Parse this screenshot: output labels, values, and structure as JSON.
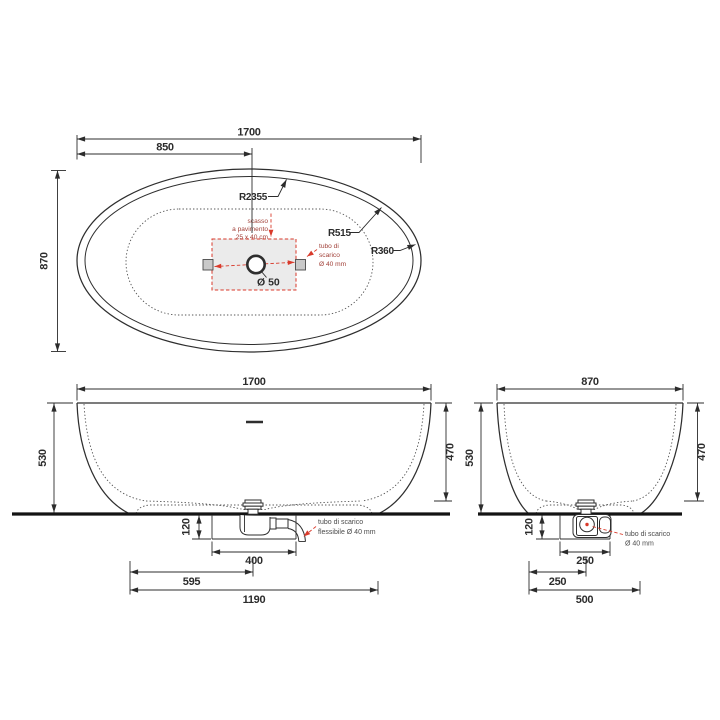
{
  "page": {
    "background": "#ffffff"
  },
  "colors": {
    "line": "#2c2c2c",
    "red_leader": "#d93a2b",
    "annotation_gray": "#4a4a4a",
    "annotation_red": "#a14038",
    "recess_fill": "#ebebeb",
    "foot_fill": "#c9c9c9"
  },
  "top_view": {
    "dim_width": "1700",
    "dim_half_width": "850",
    "dim_depth": "870",
    "radius_side": "R2355",
    "radius_inner": "R515",
    "radius_end": "R360",
    "recess_note_line1": "scasso",
    "recess_note_line2": "a pavimento",
    "recess_note_line3": "25 x 40 cm",
    "drain_note_line1": "tubo di",
    "drain_note_line2": "scarico",
    "drain_note_line3": "Ø 40 mm",
    "drain_hole_label": "Ø 50"
  },
  "front_view": {
    "dim_width": "1700",
    "dim_height": "530",
    "dim_inner_depth": "470",
    "dim_recess_depth": "120",
    "dim_recess_width": "400",
    "dim_drain_offset": "595",
    "dim_base_width": "1190",
    "hose_note_line1": "tubo di scarico",
    "hose_note_line2": "flessibile Ø 40 mm"
  },
  "side_view": {
    "dim_width": "870",
    "dim_height": "530",
    "dim_inner_depth": "470",
    "dim_recess_depth": "120",
    "dim_recess_width": "250",
    "dim_drain_offset": "250",
    "dim_base_width": "500",
    "drain_note_line1": "tubo di scarico",
    "drain_note_line2": "Ø 40 mm"
  }
}
